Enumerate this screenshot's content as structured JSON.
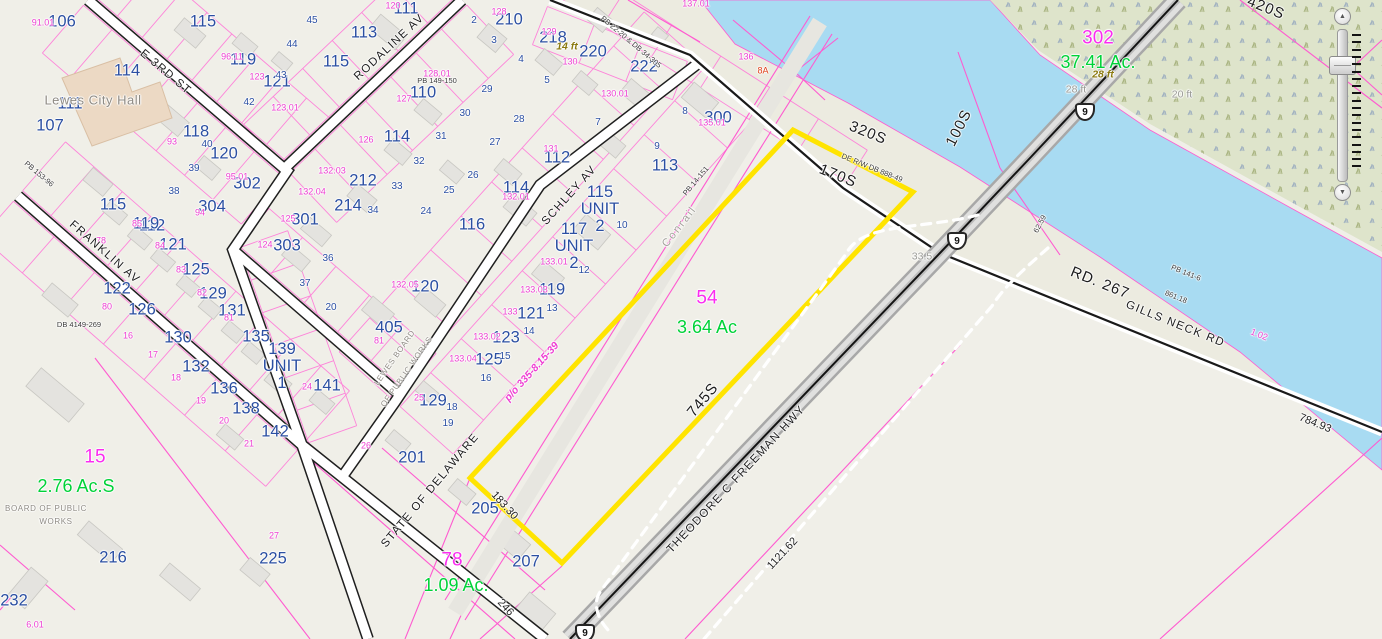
{
  "map": {
    "colors": {
      "highlight": "#ffe400",
      "parcel_line": "#ff5ad0",
      "water": "#a8dbf2",
      "marsh": "#dee4cb",
      "parcel_number_blue": "#2b4fa2",
      "parcel_id_magenta": "#fb2cf0",
      "acreage_green": "#00d238"
    },
    "labels": [
      {
        "t": "106",
        "x": 62,
        "y": 22,
        "c": "b"
      },
      {
        "t": "115",
        "x": 203,
        "y": 22,
        "c": "b"
      },
      {
        "t": "111",
        "x": 406,
        "y": 9,
        "c": "b"
      },
      {
        "t": "113",
        "x": 364,
        "y": 33,
        "c": "b"
      },
      {
        "t": "119",
        "x": 243,
        "y": 60,
        "c": "b"
      },
      {
        "t": "121",
        "x": 277,
        "y": 82,
        "c": "b"
      },
      {
        "t": "115",
        "x": 336,
        "y": 62,
        "c": "b"
      },
      {
        "t": "114",
        "x": 127,
        "y": 71,
        "c": "b"
      },
      {
        "t": "111",
        "x": 70,
        "y": 104,
        "c": "b"
      },
      {
        "t": "107",
        "x": 50,
        "y": 126,
        "c": "b"
      },
      {
        "t": "118",
        "x": 196,
        "y": 132,
        "c": "b"
      },
      {
        "t": "120",
        "x": 224,
        "y": 154,
        "c": "b"
      },
      {
        "t": "302",
        "x": 247,
        "y": 184,
        "c": "b"
      },
      {
        "t": "304",
        "x": 212,
        "y": 207,
        "c": "b"
      },
      {
        "t": "115",
        "x": 113,
        "y": 205,
        "c": "b"
      },
      {
        "t": "110",
        "x": 423,
        "y": 93,
        "c": "b"
      },
      {
        "t": "210",
        "x": 509,
        "y": 20,
        "c": "b"
      },
      {
        "t": "218",
        "x": 553,
        "y": 38,
        "c": "b"
      },
      {
        "t": "220",
        "x": 593,
        "y": 52,
        "c": "b"
      },
      {
        "t": "222",
        "x": 644,
        "y": 67,
        "c": "b"
      },
      {
        "t": "212",
        "x": 363,
        "y": 181,
        "c": "b"
      },
      {
        "t": "114",
        "x": 397,
        "y": 137,
        "c": "b"
      },
      {
        "t": "112",
        "x": 557,
        "y": 158,
        "c": "b"
      },
      {
        "t": "114",
        "x": 516,
        "y": 188,
        "c": "b"
      },
      {
        "t": "116",
        "x": 472,
        "y": 225,
        "c": "b"
      },
      {
        "t": "300",
        "x": 718,
        "y": 118,
        "c": "b"
      },
      {
        "t": "113",
        "x": 665,
        "y": 166,
        "c": "b"
      },
      {
        "t": "112",
        "x": 152,
        "y": 226,
        "c": "b"
      },
      {
        "t": "119",
        "x": 146,
        "y": 224,
        "c": "b"
      },
      {
        "t": "121",
        "x": 173,
        "y": 245,
        "c": "b"
      },
      {
        "t": "125",
        "x": 196,
        "y": 270,
        "c": "b"
      },
      {
        "t": "122",
        "x": 117,
        "y": 289,
        "c": "b"
      },
      {
        "t": "126",
        "x": 142,
        "y": 310,
        "c": "b"
      },
      {
        "t": "129",
        "x": 213,
        "y": 294,
        "c": "b"
      },
      {
        "t": "131",
        "x": 232,
        "y": 311,
        "c": "b"
      },
      {
        "t": "135",
        "x": 256,
        "y": 337,
        "c": "b"
      },
      {
        "t": "130",
        "x": 178,
        "y": 338,
        "c": "b"
      },
      {
        "t": "132",
        "x": 196,
        "y": 367,
        "c": "b"
      },
      {
        "t": "136",
        "x": 224,
        "y": 389,
        "c": "b"
      },
      {
        "t": "138",
        "x": 246,
        "y": 409,
        "c": "b"
      },
      {
        "t": "142",
        "x": 275,
        "y": 432,
        "c": "b"
      },
      {
        "t": "141",
        "x": 327,
        "y": 386,
        "c": "b"
      },
      {
        "t": "301",
        "x": 305,
        "y": 220,
        "c": "b"
      },
      {
        "t": "303",
        "x": 287,
        "y": 246,
        "c": "b"
      },
      {
        "t": "214",
        "x": 348,
        "y": 206,
        "c": "b"
      },
      {
        "t": "119",
        "x": 552,
        "y": 290,
        "c": "b"
      },
      {
        "t": "121",
        "x": 531,
        "y": 314,
        "c": "b"
      },
      {
        "t": "123",
        "x": 506,
        "y": 338,
        "c": "b"
      },
      {
        "t": "125",
        "x": 489,
        "y": 360,
        "c": "b"
      },
      {
        "t": "120",
        "x": 425,
        "y": 287,
        "c": "b"
      },
      {
        "t": "405",
        "x": 389,
        "y": 328,
        "c": "b"
      },
      {
        "t": "129",
        "x": 433,
        "y": 401,
        "c": "b"
      },
      {
        "t": "201",
        "x": 412,
        "y": 458,
        "c": "b"
      },
      {
        "t": "205",
        "x": 485,
        "y": 509,
        "c": "b"
      },
      {
        "t": "207",
        "x": 526,
        "y": 562,
        "c": "b"
      },
      {
        "t": "216",
        "x": 113,
        "y": 558,
        "c": "b"
      },
      {
        "t": "232",
        "x": 14,
        "y": 601,
        "c": "b"
      },
      {
        "t": "225",
        "x": 273,
        "y": 559,
        "c": "b"
      },
      {
        "t": "115\nUNIT\n2",
        "x": 600,
        "y": 209,
        "c": "b"
      },
      {
        "t": "117\nUNIT\n2",
        "x": 574,
        "y": 246,
        "c": "b"
      },
      {
        "t": "139\nUNIT\n1",
        "x": 282,
        "y": 366,
        "c": "b"
      },
      {
        "t": "45",
        "x": 312,
        "y": 21,
        "c": "bs"
      },
      {
        "t": "44",
        "x": 292,
        "y": 45,
        "c": "bs"
      },
      {
        "t": "43",
        "x": 281,
        "y": 76,
        "c": "bs"
      },
      {
        "t": "42",
        "x": 249,
        "y": 103,
        "c": "bs"
      },
      {
        "t": "40",
        "x": 207,
        "y": 145,
        "c": "bs"
      },
      {
        "t": "39",
        "x": 194,
        "y": 169,
        "c": "bs"
      },
      {
        "t": "38",
        "x": 174,
        "y": 192,
        "c": "bs"
      },
      {
        "t": "2",
        "x": 474,
        "y": 21,
        "c": "bs"
      },
      {
        "t": "3",
        "x": 494,
        "y": 41,
        "c": "bs"
      },
      {
        "t": "4",
        "x": 521,
        "y": 60,
        "c": "bs"
      },
      {
        "t": "5",
        "x": 547,
        "y": 81,
        "c": "bs"
      },
      {
        "t": "7",
        "x": 598,
        "y": 123,
        "c": "bs"
      },
      {
        "t": "8",
        "x": 685,
        "y": 112,
        "c": "bs"
      },
      {
        "t": "9",
        "x": 657,
        "y": 147,
        "c": "bs"
      },
      {
        "t": "10",
        "x": 622,
        "y": 226,
        "c": "bs"
      },
      {
        "t": "12",
        "x": 584,
        "y": 271,
        "c": "bs"
      },
      {
        "t": "13",
        "x": 552,
        "y": 309,
        "c": "bs"
      },
      {
        "t": "14",
        "x": 529,
        "y": 332,
        "c": "bs"
      },
      {
        "t": "15",
        "x": 505,
        "y": 357,
        "c": "bs"
      },
      {
        "t": "16",
        "x": 486,
        "y": 379,
        "c": "bs"
      },
      {
        "t": "29",
        "x": 487,
        "y": 90,
        "c": "bs"
      },
      {
        "t": "30",
        "x": 465,
        "y": 114,
        "c": "bs"
      },
      {
        "t": "28",
        "x": 519,
        "y": 120,
        "c": "bs"
      },
      {
        "t": "31",
        "x": 441,
        "y": 137,
        "c": "bs"
      },
      {
        "t": "32",
        "x": 419,
        "y": 162,
        "c": "bs"
      },
      {
        "t": "27",
        "x": 495,
        "y": 143,
        "c": "bs"
      },
      {
        "t": "26",
        "x": 473,
        "y": 176,
        "c": "bs"
      },
      {
        "t": "33",
        "x": 397,
        "y": 187,
        "c": "bs"
      },
      {
        "t": "25",
        "x": 449,
        "y": 191,
        "c": "bs"
      },
      {
        "t": "24",
        "x": 426,
        "y": 212,
        "c": "bs"
      },
      {
        "t": "34",
        "x": 373,
        "y": 211,
        "c": "bs"
      },
      {
        "t": "36",
        "x": 328,
        "y": 259,
        "c": "bs"
      },
      {
        "t": "37",
        "x": 305,
        "y": 284,
        "c": "bs"
      },
      {
        "t": "20",
        "x": 331,
        "y": 308,
        "c": "bs"
      },
      {
        "t": "18",
        "x": 452,
        "y": 408,
        "c": "bs"
      },
      {
        "t": "19",
        "x": 448,
        "y": 424,
        "c": "bs"
      },
      {
        "t": "91.01",
        "x": 43,
        "y": 23,
        "c": "p"
      },
      {
        "t": "96.11",
        "x": 232,
        "y": 57,
        "c": "p"
      },
      {
        "t": "123",
        "x": 257,
        "y": 77,
        "c": "p"
      },
      {
        "t": "123.01",
        "x": 285,
        "y": 108,
        "c": "p"
      },
      {
        "t": "93",
        "x": 172,
        "y": 142,
        "c": "p"
      },
      {
        "t": "95.01",
        "x": 237,
        "y": 177,
        "c": "p"
      },
      {
        "t": "94",
        "x": 200,
        "y": 213,
        "c": "p"
      },
      {
        "t": "128",
        "x": 499,
        "y": 12,
        "c": "p"
      },
      {
        "t": "120",
        "x": 393,
        "y": 6,
        "c": "p"
      },
      {
        "t": "129",
        "x": 549,
        "y": 32,
        "c": "p"
      },
      {
        "t": "130",
        "x": 570,
        "y": 62,
        "c": "p"
      },
      {
        "t": "128.01",
        "x": 437,
        "y": 74,
        "c": "p"
      },
      {
        "t": "127",
        "x": 404,
        "y": 99,
        "c": "p"
      },
      {
        "t": "126",
        "x": 366,
        "y": 140,
        "c": "p"
      },
      {
        "t": "131",
        "x": 551,
        "y": 149,
        "c": "p"
      },
      {
        "t": "132.01",
        "x": 516,
        "y": 197,
        "c": "p"
      },
      {
        "t": "130.01",
        "x": 615,
        "y": 94,
        "c": "p"
      },
      {
        "t": "135.01",
        "x": 712,
        "y": 123,
        "c": "p"
      },
      {
        "t": "137.01",
        "x": 696,
        "y": 4,
        "c": "p"
      },
      {
        "t": "136",
        "x": 746,
        "y": 57,
        "c": "p"
      },
      {
        "t": "132.03",
        "x": 332,
        "y": 171,
        "c": "p"
      },
      {
        "t": "132.04",
        "x": 312,
        "y": 192,
        "c": "p"
      },
      {
        "t": "133.01",
        "x": 554,
        "y": 262,
        "c": "p"
      },
      {
        "t": "133.03",
        "x": 534,
        "y": 290,
        "c": "p"
      },
      {
        "t": "133",
        "x": 510,
        "y": 312,
        "c": "p"
      },
      {
        "t": "133.02",
        "x": 487,
        "y": 337,
        "c": "p"
      },
      {
        "t": "133.04",
        "x": 463,
        "y": 359,
        "c": "p"
      },
      {
        "t": "132.05",
        "x": 405,
        "y": 285,
        "c": "p"
      },
      {
        "t": "81",
        "x": 379,
        "y": 341,
        "c": "p"
      },
      {
        "t": "25",
        "x": 419,
        "y": 398,
        "c": "p"
      },
      {
        "t": "26",
        "x": 366,
        "y": 446,
        "c": "p"
      },
      {
        "t": "78",
        "x": 101,
        "y": 241,
        "c": "p"
      },
      {
        "t": "85",
        "x": 137,
        "y": 224,
        "c": "p"
      },
      {
        "t": "84",
        "x": 160,
        "y": 246,
        "c": "p"
      },
      {
        "t": "83",
        "x": 181,
        "y": 270,
        "c": "p"
      },
      {
        "t": "82",
        "x": 202,
        "y": 293,
        "c": "p"
      },
      {
        "t": "81",
        "x": 229,
        "y": 318,
        "c": "p"
      },
      {
        "t": "80",
        "x": 107,
        "y": 307,
        "c": "p"
      },
      {
        "t": "125",
        "x": 288,
        "y": 219,
        "c": "p"
      },
      {
        "t": "124",
        "x": 265,
        "y": 245,
        "c": "p"
      },
      {
        "t": "16",
        "x": 128,
        "y": 336,
        "c": "p"
      },
      {
        "t": "17",
        "x": 153,
        "y": 355,
        "c": "p"
      },
      {
        "t": "18",
        "x": 176,
        "y": 378,
        "c": "p"
      },
      {
        "t": "19",
        "x": 201,
        "y": 401,
        "c": "p"
      },
      {
        "t": "20",
        "x": 224,
        "y": 421,
        "c": "p"
      },
      {
        "t": "21",
        "x": 249,
        "y": 444,
        "c": "p"
      },
      {
        "t": "27",
        "x": 274,
        "y": 536,
        "c": "p"
      },
      {
        "t": "24",
        "x": 307,
        "y": 387,
        "c": "p"
      },
      {
        "t": "6.01",
        "x": 35,
        "y": 625,
        "c": "p"
      },
      {
        "t": "1.02",
        "x": 1259,
        "y": 335,
        "r": 22,
        "c": "p"
      },
      {
        "t": "302",
        "x": 1098,
        "y": 38,
        "c": "m"
      },
      {
        "t": "15",
        "x": 95,
        "y": 457,
        "c": "m"
      },
      {
        "t": "78",
        "x": 452,
        "y": 560,
        "c": "m"
      },
      {
        "t": "54",
        "x": 707,
        "y": 298,
        "c": "m"
      },
      {
        "t": "37.41 Ac.",
        "x": 1098,
        "y": 62,
        "c": "g"
      },
      {
        "t": "2.76 Ac.S",
        "x": 76,
        "y": 486,
        "c": "g"
      },
      {
        "t": "1.09 Ac.",
        "x": 456,
        "y": 585,
        "c": "g"
      },
      {
        "t": "3.64 Ac",
        "x": 707,
        "y": 327,
        "c": "g"
      },
      {
        "t": "8A",
        "x": 763,
        "y": 71,
        "c": "red"
      },
      {
        "t": "28 ft",
        "x": 1103,
        "y": 75,
        "c": "ol"
      },
      {
        "t": "14 ft",
        "x": 567,
        "y": 47,
        "c": "ol"
      },
      {
        "t": "28 ft",
        "x": 1076,
        "y": 90,
        "c": "gr"
      },
      {
        "t": "20 ft",
        "x": 1182,
        "y": 95,
        "c": "gr"
      },
      {
        "t": "33.5",
        "x": 922,
        "y": 257,
        "c": "gr"
      },
      {
        "t": "Lewes City Hall",
        "x": 93,
        "y": 100,
        "c": "city"
      },
      {
        "t": "BOARD OF PUBLIC",
        "x": 46,
        "y": 509,
        "c": "tg"
      },
      {
        "t": "WORKS",
        "x": 56,
        "y": 522,
        "c": "tg"
      },
      {
        "t": "LEWES BOARD",
        "x": 395,
        "y": 358,
        "r": -55,
        "c": "tg"
      },
      {
        "t": "OF PUBLIC WORKS",
        "x": 407,
        "y": 372,
        "r": -55,
        "c": "tg"
      },
      {
        "t": "E 3RD ST",
        "x": 165,
        "y": 73,
        "r": 40,
        "c": "st"
      },
      {
        "t": "RODALINE AV",
        "x": 390,
        "y": 48,
        "r": -43,
        "c": "st"
      },
      {
        "t": "SCHLEY AV",
        "x": 570,
        "y": 196,
        "r": -48,
        "c": "st"
      },
      {
        "t": "FRANKLIN AV",
        "x": 104,
        "y": 253,
        "r": 41,
        "c": "st"
      },
      {
        "t": "GILLS NECK RD",
        "x": 1175,
        "y": 325,
        "r": 22,
        "c": "st"
      },
      {
        "t": "STATE OF DELAWARE",
        "x": 431,
        "y": 491,
        "r": -50,
        "c": "st"
      },
      {
        "t": "THEODORE C FREEMAN HWY",
        "x": 737,
        "y": 480,
        "r": -47,
        "c": "st"
      },
      {
        "t": "RD. 267",
        "x": 1100,
        "y": 283,
        "r": 22,
        "c": "stl"
      },
      {
        "t": "320S",
        "x": 868,
        "y": 133,
        "r": 22,
        "c": "stl"
      },
      {
        "t": "100S",
        "x": 959,
        "y": 128,
        "r": -63,
        "c": "stl"
      },
      {
        "t": "170S",
        "x": 838,
        "y": 176,
        "r": 22,
        "c": "stl"
      },
      {
        "t": "420S",
        "x": 1266,
        "y": 8,
        "r": 22,
        "c": "stl"
      },
      {
        "t": "745S",
        "x": 703,
        "y": 400,
        "r": -50,
        "c": "stl"
      },
      {
        "t": "Conrail",
        "x": 680,
        "y": 227,
        "r": -52,
        "c": "stg"
      },
      {
        "t": "183.30",
        "x": 504,
        "y": 506,
        "r": 48,
        "c": "d"
      },
      {
        "t": "246",
        "x": 505,
        "y": 608,
        "r": 48,
        "c": "d"
      },
      {
        "t": "1121.62",
        "x": 783,
        "y": 554,
        "r": -47,
        "c": "d"
      },
      {
        "t": "784.93",
        "x": 1315,
        "y": 424,
        "r": 22,
        "c": "d"
      },
      {
        "t": "861.18",
        "x": 1176,
        "y": 297,
        "r": 22,
        "c": "ds"
      },
      {
        "t": "PB 141-6",
        "x": 1186,
        "y": 273,
        "r": 22,
        "c": "ds"
      },
      {
        "t": "62.59",
        "x": 1040,
        "y": 224,
        "r": -62,
        "c": "ds"
      },
      {
        "t": "PB 14-151",
        "x": 696,
        "y": 181,
        "r": -50,
        "c": "ds"
      },
      {
        "t": "PB 22-20 & DB 34-305",
        "x": 631,
        "y": 42,
        "r": 40,
        "c": "ds"
      },
      {
        "t": "DE R/W DB 888-49",
        "x": 872,
        "y": 168,
        "r": 22,
        "c": "ds"
      },
      {
        "t": "PB 153-96",
        "x": 39,
        "y": 174,
        "r": 40,
        "c": "ds"
      },
      {
        "t": "DB 4149-269",
        "x": 79,
        "y": 325,
        "c": "ds"
      },
      {
        "t": "PB 149-150",
        "x": 437,
        "y": 81,
        "c": "ds"
      },
      {
        "t": "p/o 335-8.15-39",
        "x": 532,
        "y": 372,
        "r": -48,
        "c": "pi"
      }
    ],
    "route_shields": [
      {
        "t": "9",
        "x": 1085,
        "y": 112
      },
      {
        "t": "9",
        "x": 957,
        "y": 241
      },
      {
        "t": "9",
        "x": 585,
        "y": 633
      }
    ],
    "highlighted_parcel": {
      "id": "54",
      "acreage": "3.64 Ac"
    }
  },
  "controls": {
    "zoom_in": "▲",
    "zoom_out": "▼"
  }
}
